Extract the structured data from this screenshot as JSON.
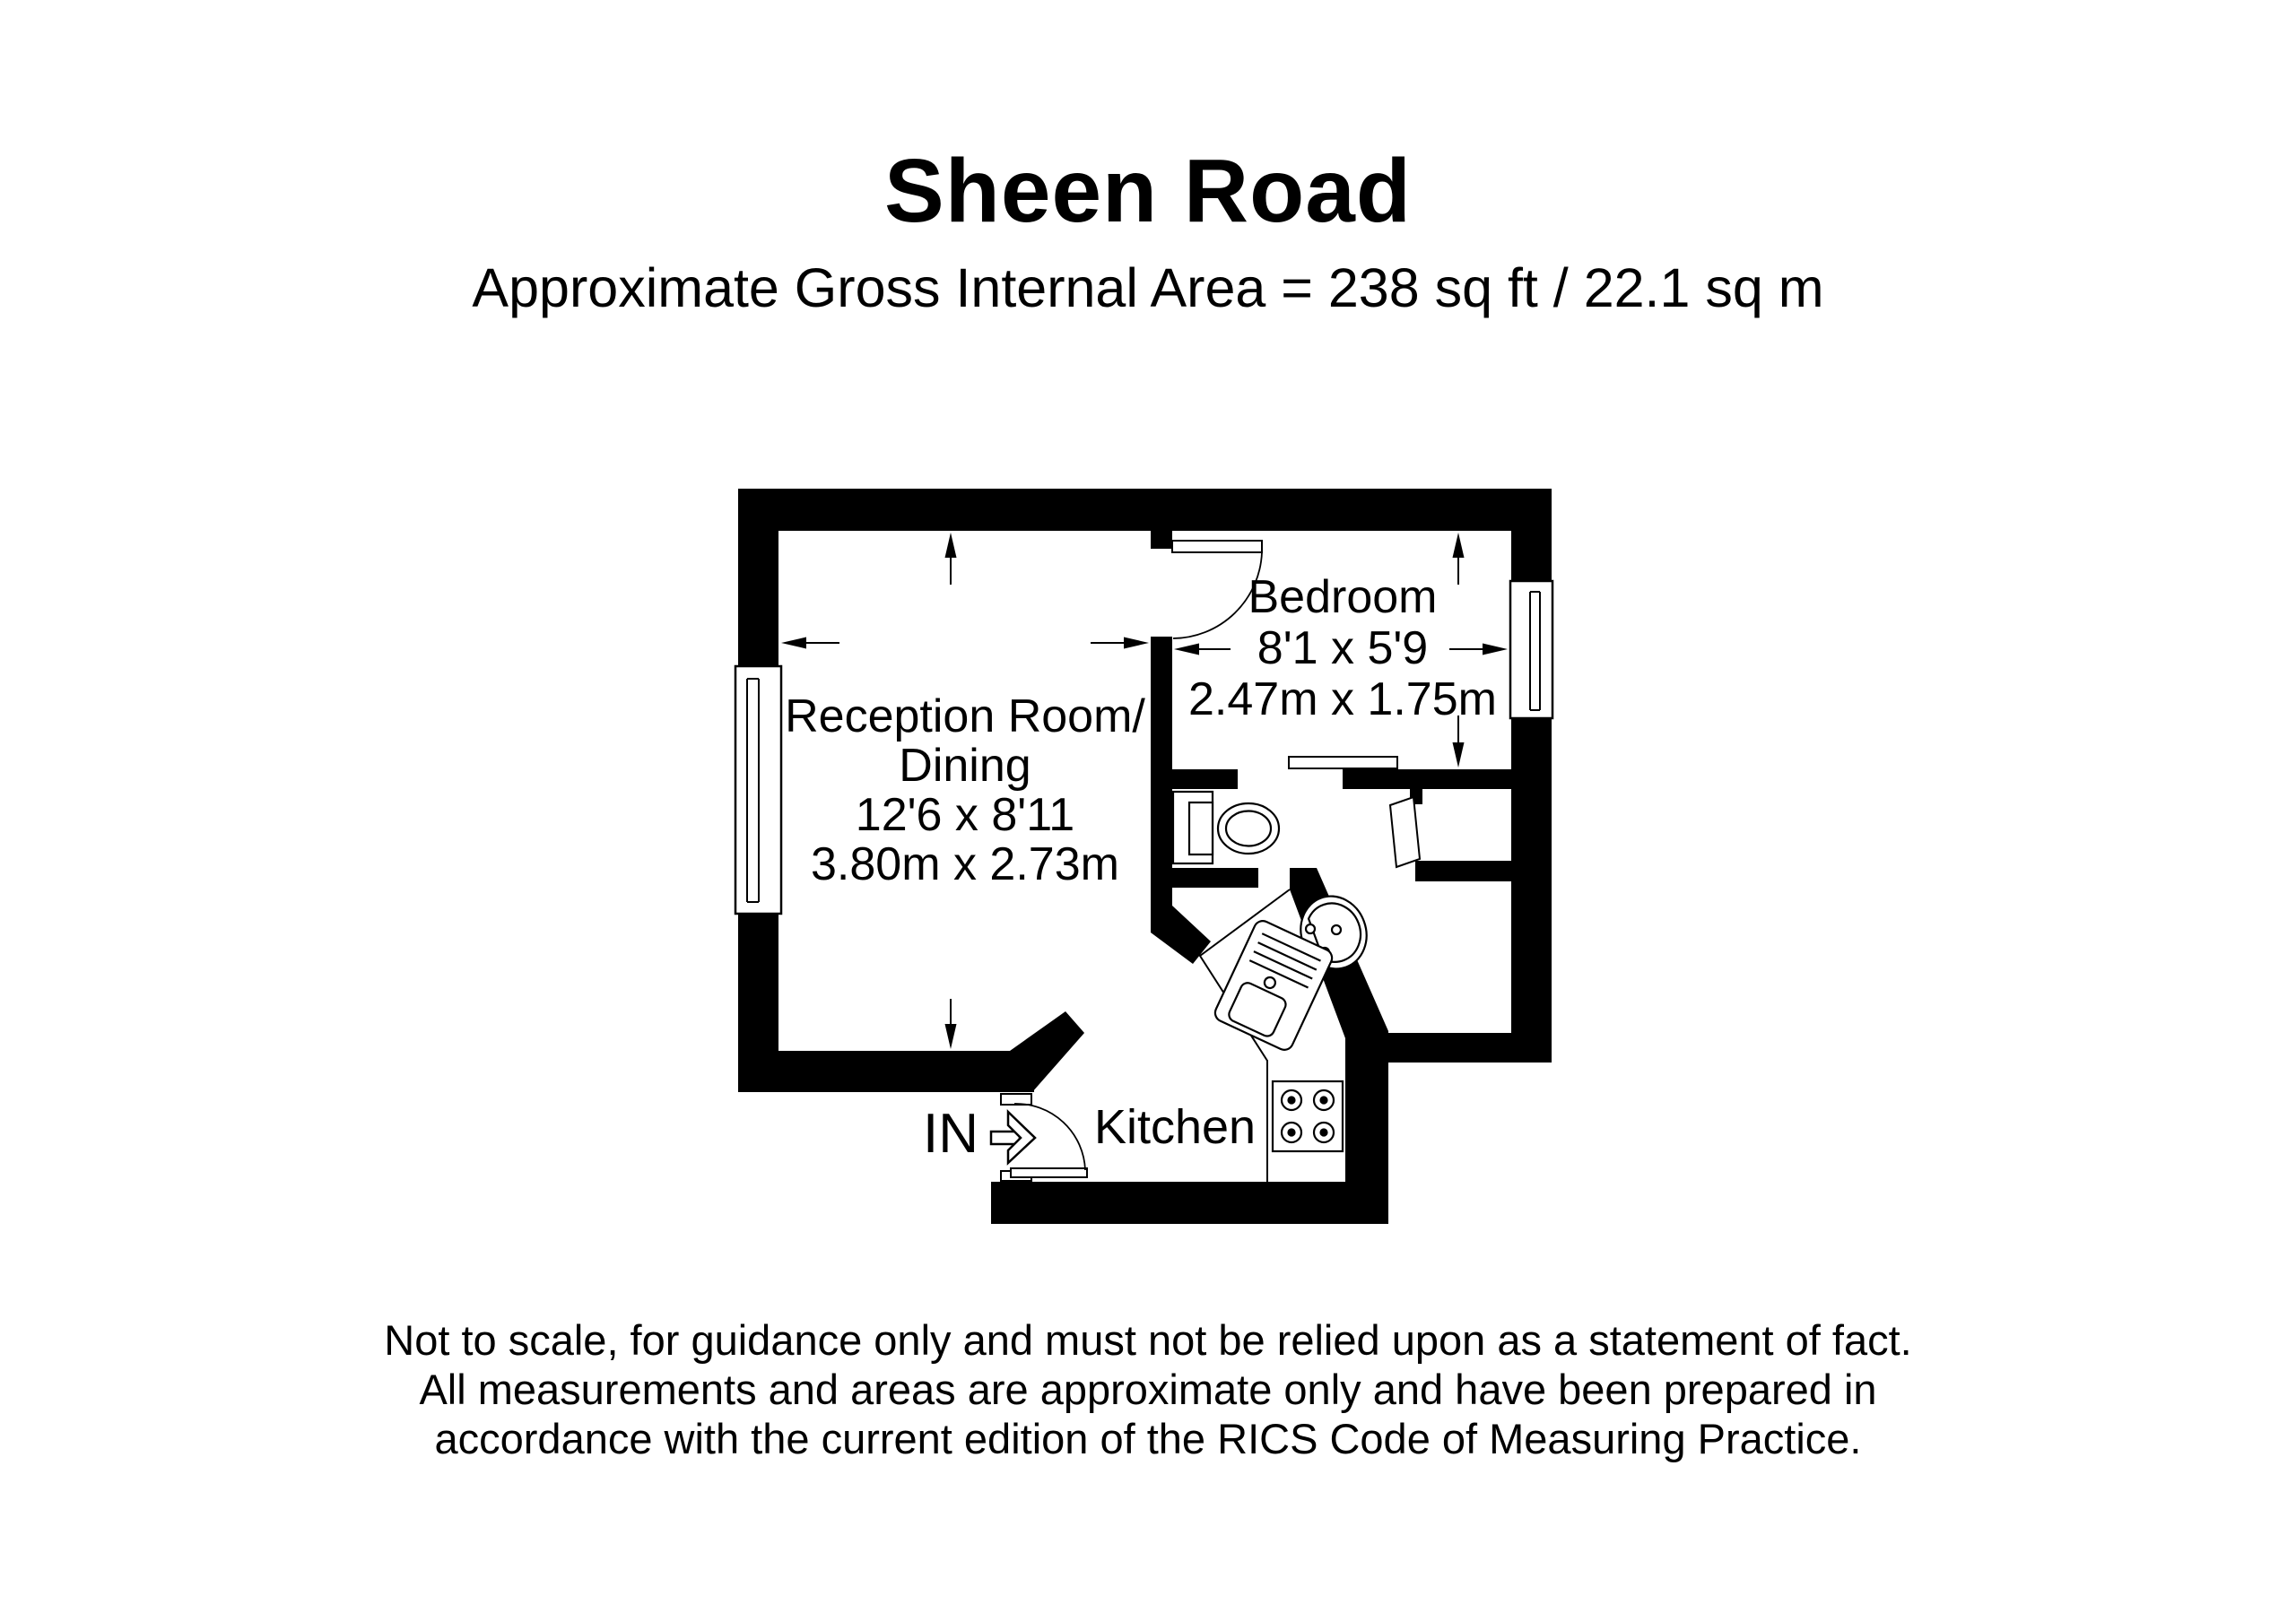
{
  "header": {
    "title": "Sheen Road",
    "subtitle": "Approximate Gross Internal Area = 238 sq ft / 22.1 sq m"
  },
  "rooms": {
    "reception": {
      "name_line1": "Reception Room/",
      "name_line2": "Dining",
      "size_imperial": "12'6 x 8'11",
      "size_metric": "3.80m x 2.73m"
    },
    "bedroom": {
      "name": "Bedroom",
      "size_imperial": "8'1 x 5'9",
      "size_metric": "2.47m x 1.75m"
    },
    "kitchen": {
      "name": "Kitchen"
    },
    "entrance": {
      "label": "IN"
    }
  },
  "footer": {
    "line1": "Not to scale, for guidance only and must not be relied upon as a statement of fact.",
    "line2": "All measurements and areas are approximate only and have been prepared in",
    "line3": "accordance with the current edition of the RICS Code of Measuring Practice."
  },
  "colors": {
    "wall": "#000000",
    "background": "#ffffff",
    "text": "#000000"
  }
}
